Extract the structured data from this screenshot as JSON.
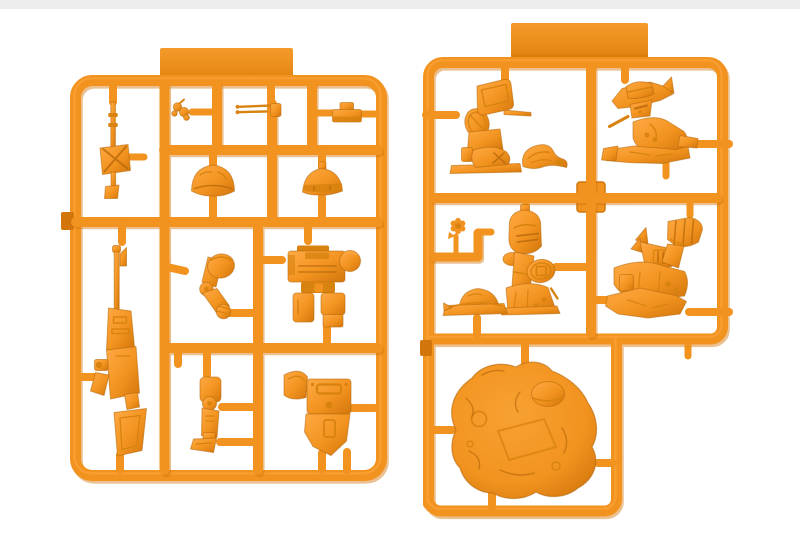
{
  "scene": {
    "subject": "Product render of two orange injection-molded plastic model-kit sprues (runners) holding unassembled chibi mecha figure parts on a white background",
    "background_color": "#FFFFFF",
    "top_strip_color": "#EDEDED"
  },
  "palette": {
    "bg": "#FFFFFF",
    "strip": "#EDEDED",
    "base": "#F2931F",
    "light": "#FFAA45",
    "hi": "#F7A132",
    "dark2": "#D8820F",
    "shade": "#D2760C",
    "deep": "#B5660A",
    "tab_top": "#F59B2B",
    "tab_bottom": "#E2830D"
  },
  "sprues": [
    {
      "id": "runner-a",
      "name": "Runner A - weapons and body parts sprue",
      "position": "left",
      "label_tab_text": "",
      "parts": [
        {
          "name": "sensor-mast",
          "slot": "top-left column"
        },
        {
          "name": "small-detail-bits",
          "slot": "top row"
        },
        {
          "name": "twin-antenna-rods",
          "slot": "top row"
        },
        {
          "name": "equipment-box",
          "slot": "top row right"
        },
        {
          "name": "dome-helmet",
          "slot": "second row left"
        },
        {
          "name": "visor-helmet",
          "slot": "second row right"
        },
        {
          "name": "bent-arm",
          "slot": "middle row left"
        },
        {
          "name": "torso-block",
          "slot": "middle row right"
        },
        {
          "name": "long-rifle",
          "slot": "bottom-left column"
        },
        {
          "name": "leg-unit",
          "slot": "bottom row center"
        },
        {
          "name": "backpack-pelvis",
          "slot": "bottom row right"
        }
      ]
    },
    {
      "id": "runner-b",
      "name": "Runner B - figures and terrain base sprue",
      "position": "right",
      "label_tab_text": "",
      "parts": [
        {
          "name": "kneeling-figure",
          "slot": "top row left"
        },
        {
          "name": "curved-shell-piece",
          "slot": "top row left"
        },
        {
          "name": "hat-scout-figure",
          "slot": "top row right"
        },
        {
          "name": "flower-bit",
          "slot": "middle row left corner"
        },
        {
          "name": "knight-figure-with-shield",
          "slot": "middle row center"
        },
        {
          "name": "brimmed-helmet",
          "slot": "middle row left"
        },
        {
          "name": "fist-raised-figure",
          "slot": "middle row right"
        },
        {
          "name": "rocky-terrain-base",
          "slot": "bottom compartment"
        }
      ]
    }
  ]
}
